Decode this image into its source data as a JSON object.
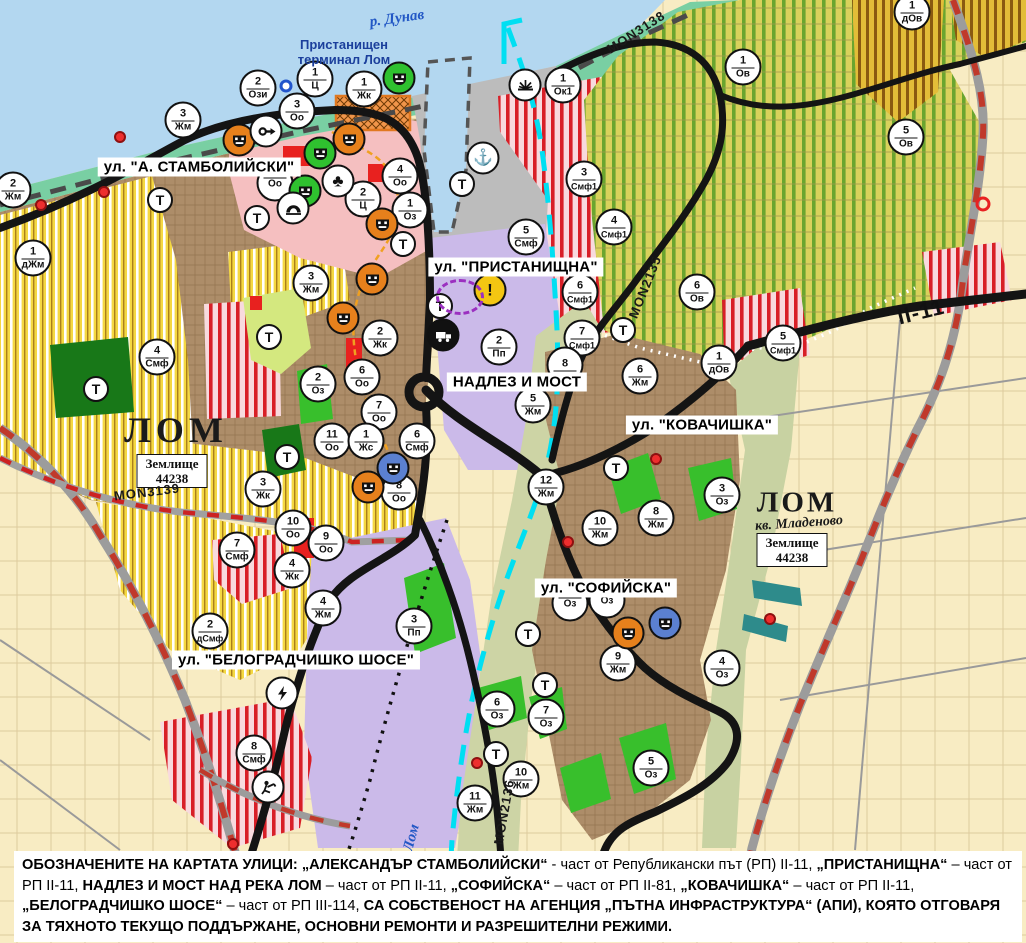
{
  "map_title": "Устройствен план – гр. Лом",
  "palette": {
    "water": "#b3d7f0",
    "shore_green": "#79cfa3",
    "port_gray": "#bcbcbc",
    "urban_brown": "#ad8d69",
    "center_pink": "#f5bfc0",
    "production_purple": "#cbbae9",
    "valley_khaki": "#cdd4a5",
    "fields_beige": "#f8ecc3",
    "park_green": "#38bf2c",
    "forest_green": "#187818",
    "red_zone": "#e8211f",
    "smf_stripe_red": "#d81f27",
    "vineyard_green": "#6aa52f",
    "hatch_yellow": "#f4d842",
    "canal_cyan": "#00dff2",
    "rail_red": "#c0392b",
    "road_black": "#141414",
    "poi_orange": "#e6801c",
    "poi_green": "#2fc12f",
    "poi_blue": "#5b80d0",
    "warning_yellow": "#f3c612"
  },
  "street_labels": [
    {
      "text": "ул. \"А. СТАМБОЛИЙСКИ\"",
      "x": 199,
      "y": 167
    },
    {
      "text": "ул. \"ПРИСТАНИЩНА\"",
      "x": 516,
      "y": 267
    },
    {
      "text": "НАДЛЕЗ И МОСТ",
      "x": 517,
      "y": 382
    },
    {
      "text": "ул. \"КОВАЧИШКА\"",
      "x": 702,
      "y": 425
    },
    {
      "text": "ул. \"СОФИЙСКА\"",
      "x": 606,
      "y": 588
    },
    {
      "text": "ул. \"БЕЛОГРАДЧИШКО ШОСЕ\"",
      "x": 296,
      "y": 660
    }
  ],
  "place_labels": [
    {
      "id": "river-danube",
      "text": "р. Дунав",
      "x": 397,
      "y": 19,
      "style": "river",
      "rot": -8
    },
    {
      "id": "port-terminal",
      "text": "Пристанищен\nтерминал Лом",
      "x": 344,
      "y": 52,
      "style": "terminal",
      "rot": 0
    },
    {
      "id": "city-lom",
      "text": "ЛОМ",
      "x": 176,
      "y": 430,
      "style": "city",
      "rot": 0
    },
    {
      "id": "city-lom-mladenovo",
      "text": "ЛОМ",
      "x": 797,
      "y": 503,
      "style": "city2",
      "rot": 0
    },
    {
      "id": "kv-mladenovo",
      "text": "кв. Младеново",
      "x": 799,
      "y": 524,
      "style": "kv",
      "rot": -4
    },
    {
      "id": "zemlishte-west",
      "text": "Землище\n44238",
      "x": 172,
      "y": 471,
      "style": "zem",
      "rot": 0
    },
    {
      "id": "zemlishte-east",
      "text": "Землище\n44238",
      "x": 792,
      "y": 550,
      "style": "zem",
      "rot": 0
    },
    {
      "id": "river-lom",
      "text": "Лом",
      "x": 412,
      "y": 838,
      "style": "river",
      "rot": -75
    }
  ],
  "road_labels": [
    {
      "text": "MON3138",
      "x": 636,
      "y": 32,
      "rot": -33,
      "big": false
    },
    {
      "text": "MON2135",
      "x": 645,
      "y": 287,
      "rot": -68,
      "big": false
    },
    {
      "text": "MON3139",
      "x": 147,
      "y": 492,
      "rot": -7,
      "big": false
    },
    {
      "text": "MON2136",
      "x": 504,
      "y": 812,
      "rot": -80,
      "big": false
    },
    {
      "text": "II-11",
      "x": 921,
      "y": 312,
      "rot": -14,
      "big": true
    }
  ],
  "t_label": "Т",
  "t_markers": [
    {
      "x": 160,
      "y": 200
    },
    {
      "x": 257,
      "y": 218
    },
    {
      "x": 462,
      "y": 184
    },
    {
      "x": 403,
      "y": 244
    },
    {
      "x": 440,
      "y": 306
    },
    {
      "x": 269,
      "y": 337
    },
    {
      "x": 96,
      "y": 389
    },
    {
      "x": 287,
      "y": 457
    },
    {
      "x": 623,
      "y": 330
    },
    {
      "x": 616,
      "y": 468
    },
    {
      "x": 528,
      "y": 634
    },
    {
      "x": 545,
      "y": 685
    },
    {
      "x": 496,
      "y": 754
    }
  ],
  "zone_markers": [
    {
      "n": "2",
      "c": "Жм",
      "x": 13,
      "y": 190
    },
    {
      "n": "3",
      "c": "Жм",
      "x": 183,
      "y": 120
    },
    {
      "n": "2",
      "c": "Ози",
      "x": 258,
      "y": 88
    },
    {
      "n": "1",
      "c": "Ц",
      "x": 315,
      "y": 79
    },
    {
      "n": "1",
      "c": "Жк",
      "x": 364,
      "y": 89
    },
    {
      "n": "3",
      "c": "Оо",
      "x": 297,
      "y": 111
    },
    {
      "n": "",
      "c": "Оо",
      "x": 275,
      "y": 183
    },
    {
      "n": "4",
      "c": "Оо",
      "x": 400,
      "y": 176
    },
    {
      "n": "2",
      "c": "Ц",
      "x": 363,
      "y": 199
    },
    {
      "n": "1",
      "c": "Оз",
      "x": 410,
      "y": 210
    },
    {
      "n": "1",
      "c": "Ок1",
      "x": 563,
      "y": 85
    },
    {
      "n": "3",
      "c": "Смф1",
      "x": 584,
      "y": 179
    },
    {
      "n": "5",
      "c": "Смф",
      "x": 526,
      "y": 237
    },
    {
      "n": "1",
      "c": "дЖм",
      "x": 33,
      "y": 258
    },
    {
      "n": "3",
      "c": "Жм",
      "x": 311,
      "y": 283
    },
    {
      "n": "4",
      "c": "Смф",
      "x": 157,
      "y": 357
    },
    {
      "n": "2",
      "c": "Оз",
      "x": 318,
      "y": 384
    },
    {
      "n": "11",
      "c": "Оо",
      "x": 332,
      "y": 441
    },
    {
      "n": "3",
      "c": "Жк",
      "x": 263,
      "y": 489
    },
    {
      "n": "2",
      "c": "Жк",
      "x": 380,
      "y": 338
    },
    {
      "n": "6",
      "c": "Оо",
      "x": 362,
      "y": 377
    },
    {
      "n": "7",
      "c": "Оо",
      "x": 379,
      "y": 412
    },
    {
      "n": "1",
      "c": "Жс",
      "x": 366,
      "y": 441
    },
    {
      "n": "6",
      "c": "Смф",
      "x": 417,
      "y": 441
    },
    {
      "n": "8",
      "c": "Оо",
      "x": 399,
      "y": 492
    },
    {
      "n": "2",
      "c": "Пп",
      "x": 499,
      "y": 347
    },
    {
      "n": "5",
      "c": "Жм",
      "x": 533,
      "y": 405
    },
    {
      "n": "12",
      "c": "Жм",
      "x": 546,
      "y": 487
    },
    {
      "n": "6",
      "c": "Смф1",
      "x": 580,
      "y": 292
    },
    {
      "n": "7",
      "c": "Смф1",
      "x": 582,
      "y": 338
    },
    {
      "n": "8",
      "c": "",
      "x": 565,
      "y": 365
    },
    {
      "n": "1",
      "c": "Ов",
      "x": 743,
      "y": 67
    },
    {
      "n": "1",
      "c": "дОв",
      "x": 912,
      "y": 12
    },
    {
      "n": "5",
      "c": "Ов",
      "x": 906,
      "y": 137
    },
    {
      "n": "4",
      "c": "Смф1",
      "x": 614,
      "y": 227
    },
    {
      "n": "6",
      "c": "Ов",
      "x": 697,
      "y": 292
    },
    {
      "n": "5",
      "c": "Смф1",
      "x": 783,
      "y": 343
    },
    {
      "n": "1",
      "c": "дОв",
      "x": 719,
      "y": 363
    },
    {
      "n": "6",
      "c": "Жм",
      "x": 640,
      "y": 376
    },
    {
      "n": "3",
      "c": "Оз",
      "x": 722,
      "y": 495
    },
    {
      "n": "8",
      "c": "Жм",
      "x": 656,
      "y": 518
    },
    {
      "n": "10",
      "c": "Жм",
      "x": 600,
      "y": 528
    },
    {
      "n": "9",
      "c": "Жм",
      "x": 618,
      "y": 663
    },
    {
      "n": "4",
      "c": "Оз",
      "x": 722,
      "y": 668
    },
    {
      "n": "5",
      "c": "Оз",
      "x": 651,
      "y": 768
    },
    {
      "n": "",
      "c": "Оз",
      "x": 570,
      "y": 603
    },
    {
      "n": "",
      "c": "Оз",
      "x": 607,
      "y": 600
    },
    {
      "n": "3",
      "c": "Пп",
      "x": 414,
      "y": 626
    },
    {
      "n": "6",
      "c": "Оз",
      "x": 497,
      "y": 709
    },
    {
      "n": "7",
      "c": "Оз",
      "x": 546,
      "y": 717
    },
    {
      "n": "10",
      "c": "Жм",
      "x": 521,
      "y": 779
    },
    {
      "n": "11",
      "c": "Жм",
      "x": 475,
      "y": 803
    },
    {
      "n": "7",
      "c": "Смф",
      "x": 237,
      "y": 550
    },
    {
      "n": "4",
      "c": "Жк",
      "x": 292,
      "y": 570
    },
    {
      "n": "4",
      "c": "Жм",
      "x": 323,
      "y": 608
    },
    {
      "n": "2",
      "c": "дСмф",
      "x": 210,
      "y": 631
    },
    {
      "n": "8",
      "c": "Смф",
      "x": 254,
      "y": 753
    },
    {
      "n": "10",
      "c": "Оо",
      "x": 293,
      "y": 528
    },
    {
      "n": "9",
      "c": "Оо",
      "x": 326,
      "y": 543
    }
  ],
  "poi_markers": [
    {
      "icon": "masks",
      "color": "orange",
      "x": 239,
      "y": 140
    },
    {
      "icon": "masks",
      "color": "orange",
      "x": 349,
      "y": 139
    },
    {
      "icon": "masks",
      "color": "orange",
      "x": 382,
      "y": 224
    },
    {
      "icon": "masks",
      "color": "orange",
      "x": 372,
      "y": 279
    },
    {
      "icon": "masks",
      "color": "orange",
      "x": 343,
      "y": 318
    },
    {
      "icon": "masks",
      "color": "orange",
      "x": 368,
      "y": 487
    },
    {
      "icon": "masks",
      "color": "orange",
      "x": 628,
      "y": 633
    },
    {
      "icon": "masks",
      "color": "green",
      "x": 399,
      "y": 78
    },
    {
      "icon": "masks",
      "color": "green",
      "x": 320,
      "y": 153
    },
    {
      "icon": "masks",
      "color": "green",
      "x": 305,
      "y": 191
    },
    {
      "icon": "masks",
      "color": "blue",
      "x": 393,
      "y": 468
    },
    {
      "icon": "masks",
      "color": "blue",
      "x": 665,
      "y": 623
    },
    {
      "icon": "key",
      "color": "white",
      "x": 266,
      "y": 131
    },
    {
      "icon": "club",
      "color": "white",
      "x": 338,
      "y": 181
    },
    {
      "icon": "cave",
      "color": "white",
      "x": 293,
      "y": 208
    },
    {
      "icon": "anchor",
      "color": "white",
      "x": 483,
      "y": 158
    },
    {
      "icon": "sun",
      "color": "white",
      "x": 525,
      "y": 85
    },
    {
      "icon": "warning",
      "color": "yellow",
      "x": 490,
      "y": 290
    },
    {
      "icon": "truck",
      "color": "black",
      "x": 443,
      "y": 335
    },
    {
      "icon": "lightning",
      "color": "white",
      "x": 282,
      "y": 693
    },
    {
      "icon": "roadworks",
      "color": "white",
      "x": 268,
      "y": 787
    }
  ],
  "small_markers": [
    {
      "kind": "red-dot",
      "x": 120,
      "y": 137
    },
    {
      "kind": "red-dot",
      "x": 104,
      "y": 192
    },
    {
      "kind": "red-dot",
      "x": 41,
      "y": 205
    },
    {
      "kind": "red-dot",
      "x": 568,
      "y": 542
    },
    {
      "kind": "red-dot",
      "x": 656,
      "y": 459
    },
    {
      "kind": "red-dot",
      "x": 770,
      "y": 619
    },
    {
      "kind": "red-dot",
      "x": 477,
      "y": 763
    },
    {
      "kind": "red-dot",
      "x": 233,
      "y": 844
    },
    {
      "kind": "red-ring",
      "x": 983,
      "y": 204
    },
    {
      "kind": "blue-ring",
      "x": 286,
      "y": 86
    },
    {
      "kind": "purple-ellipse",
      "x": 460,
      "y": 297
    }
  ],
  "legend": {
    "segments": [
      {
        "t": "ОБОЗНАЧЕНИТЕ НА КАРТАТА УЛИЦИ: ",
        "b": 1
      },
      {
        "t": "„АЛЕКСАНДЪР СТАМБОЛИЙСКИ“",
        "b": 1
      },
      {
        "t": " - част от Републикански път (РП) II-11, ",
        "b": 0
      },
      {
        "t": "„ПРИСТАНИЩНА“",
        "b": 1
      },
      {
        "t": " – част от РП II-11, ",
        "b": 0
      },
      {
        "t": "НАДЛЕЗ И МОСТ НАД РЕКА ЛОМ",
        "b": 1
      },
      {
        "t": " – част от РП II-11, ",
        "b": 0
      },
      {
        "t": "„СОФИЙСКА“",
        "b": 1
      },
      {
        "t": " – част от РП II-81, ",
        "b": 0
      },
      {
        "t": "„КОВАЧИШКА“",
        "b": 1
      },
      {
        "t": " – част от РП II-11, ",
        "b": 0
      },
      {
        "t": "„БЕЛОГРАДЧИШКО ШОСЕ“",
        "b": 1
      },
      {
        "t": " – част от РП III-114, ",
        "b": 0
      },
      {
        "t": "СА СОБСТВЕНОСТ НА АГЕНЦИЯ „ПЪТНА ИНФРАСТРУКТУРА“ (АПИ), КОЯТО ОТГОВАРЯ ЗА ТЯХНОТО ТЕКУЩО ПОДДЪРЖАНЕ, ОСНОВНИ РЕМОНТИ И РАЗРЕШИТЕЛНИ РЕЖИМИ.",
        "b": 1
      }
    ]
  }
}
